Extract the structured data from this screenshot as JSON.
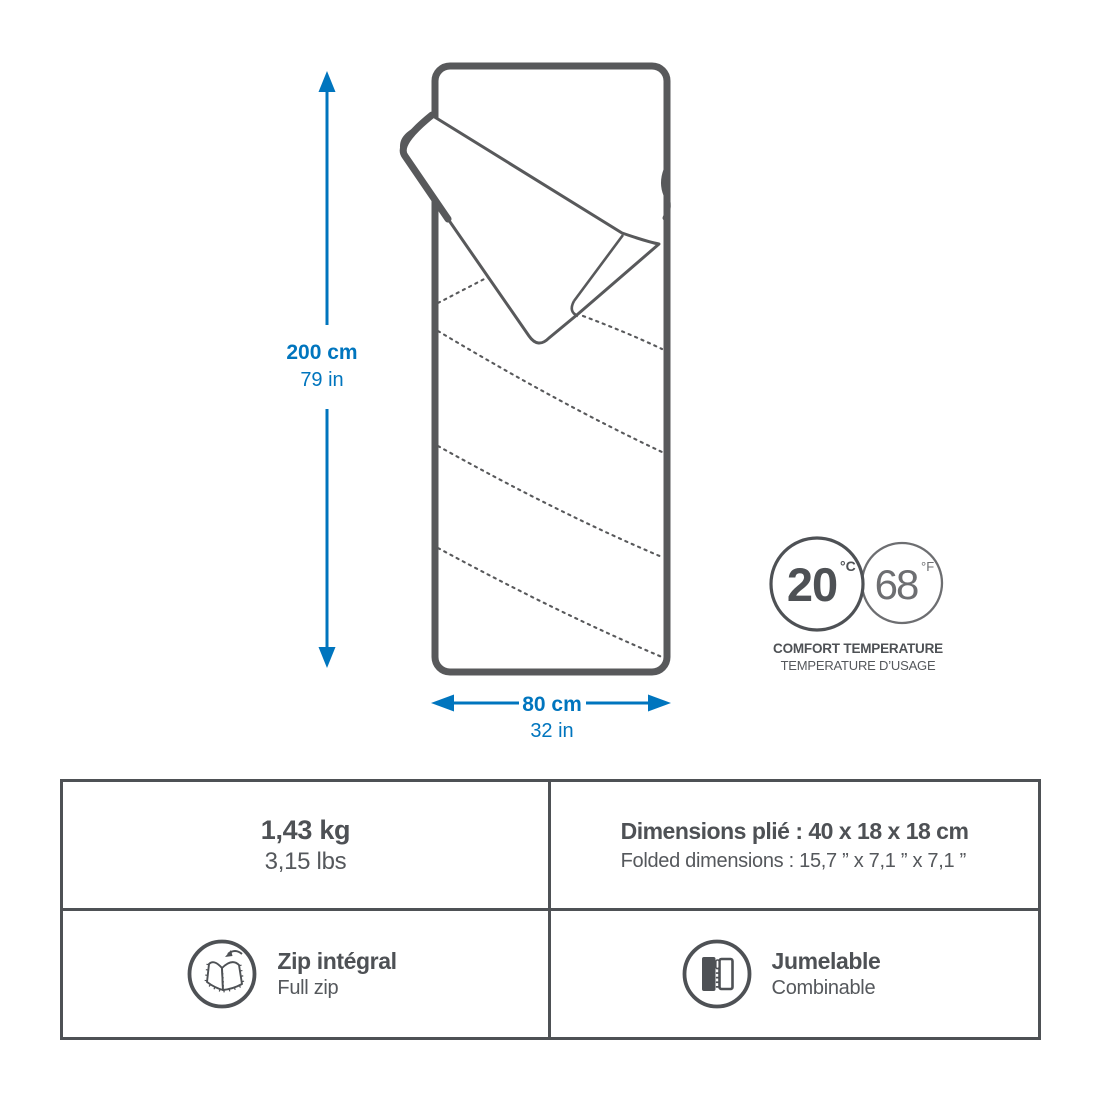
{
  "colors": {
    "accent_blue": "#0075BE",
    "outline_gray": "#58595B",
    "text_dark": "#4E5155",
    "text_mid": "#6D6E71"
  },
  "diagram": {
    "length_label": {
      "metric": "200 cm",
      "imperial": "79 in"
    },
    "width_label": {
      "metric": "80 cm",
      "imperial": "32 in"
    },
    "comfort": {
      "celsius_value": "20",
      "celsius_unit": "°C",
      "fahrenheit_value": "68",
      "fahrenheit_unit": "°F",
      "caption_en": "COMFORT TEMPERATURE",
      "caption_fr": "TEMPERATURE D’USAGE"
    }
  },
  "specs": {
    "weight": {
      "primary": "1,43 kg",
      "secondary": "3,15 lbs"
    },
    "folded_dimensions": {
      "primary": "Dimensions plié : 40 x 18 x 18 cm",
      "secondary": "Folded dimensions : 15,7 ” x 7,1 ” x 7,1 ”"
    },
    "zip": {
      "primary": "Zip intégral",
      "secondary": "Full zip"
    },
    "pairing": {
      "primary": "Jumelable",
      "secondary": "Combinable"
    }
  }
}
